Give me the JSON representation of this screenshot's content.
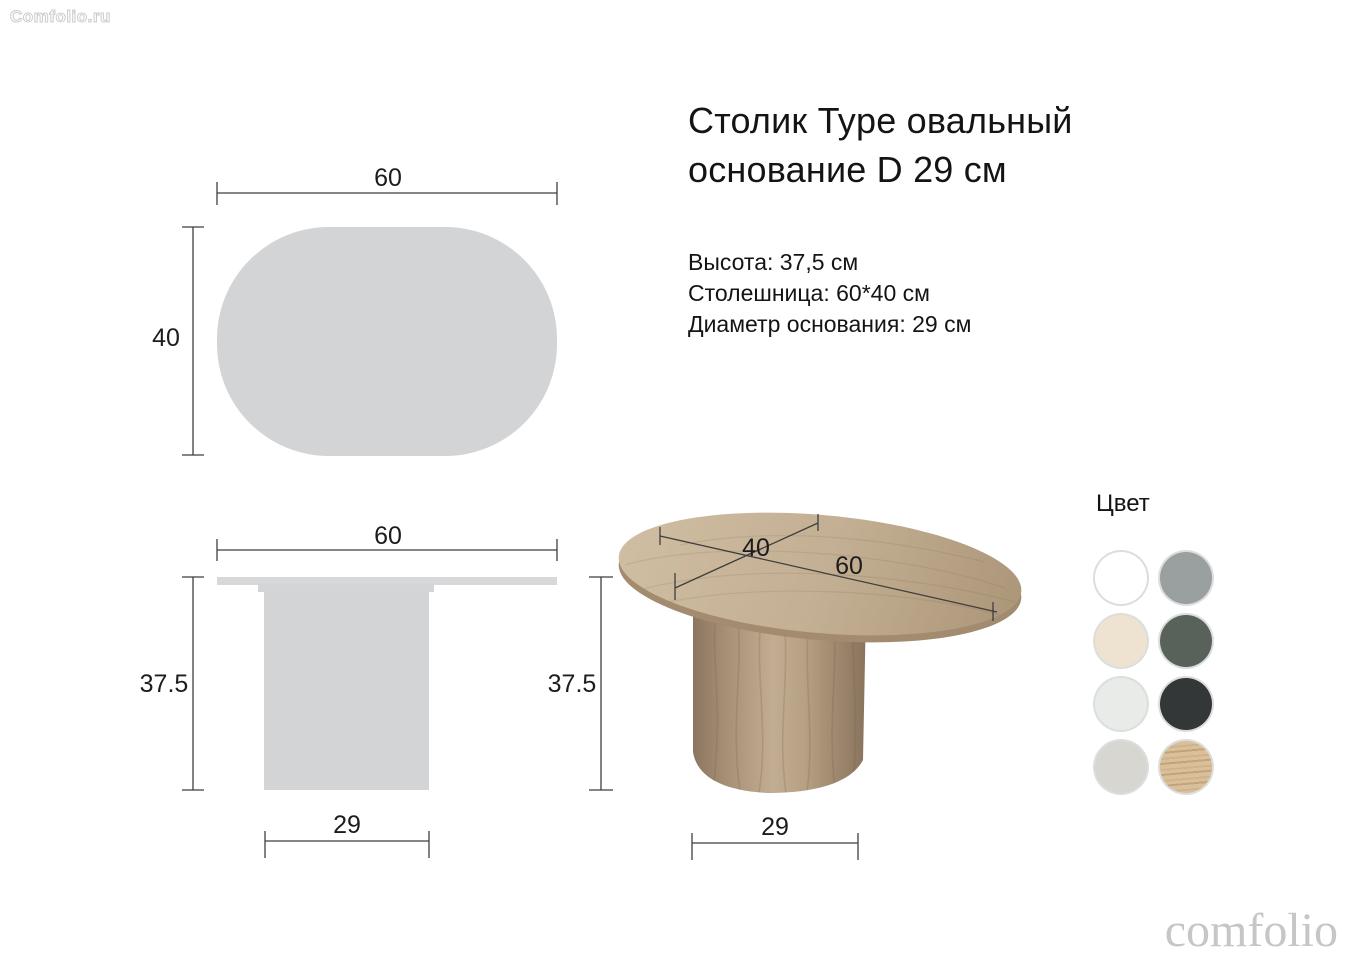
{
  "watermark": "Comfolio.ru",
  "brand_logo": "comfolio",
  "header": {
    "title_line1": "Столик Type овальный",
    "title_line2": "основание D 29 см"
  },
  "specs": {
    "height": "Высота: 37,5 см",
    "tabletop": "Столешница: 60*40 см",
    "base_diameter": "Диаметр основания: 29 см"
  },
  "dims": {
    "top_view": {
      "width": "60",
      "depth": "40"
    },
    "side_view": {
      "width": "60",
      "height": "37.5",
      "base": "29"
    },
    "render_view": {
      "depth": "40",
      "width": "60",
      "height": "37.5",
      "base": "29"
    }
  },
  "colors_section": {
    "heading": "Цвет",
    "swatches": [
      {
        "name": "white",
        "hex": "#ffffff"
      },
      {
        "name": "gray",
        "hex": "#9aa09f"
      },
      {
        "name": "cream",
        "hex": "#ede3d0"
      },
      {
        "name": "graphite-green",
        "hex": "#59615b"
      },
      {
        "name": "light-gray",
        "hex": "#e9ebe8"
      },
      {
        "name": "charcoal",
        "hex": "#343738"
      },
      {
        "name": "stone-gray",
        "hex": "#d8d6d1"
      },
      {
        "name": "light-oak",
        "hex": "#d9c09b"
      }
    ]
  },
  "palette": {
    "schematic_fill": "#d2d4d5",
    "dimension_line": "#3e3e3e",
    "wood_light": "#c2ad92",
    "wood_dark": "#8c7660"
  }
}
